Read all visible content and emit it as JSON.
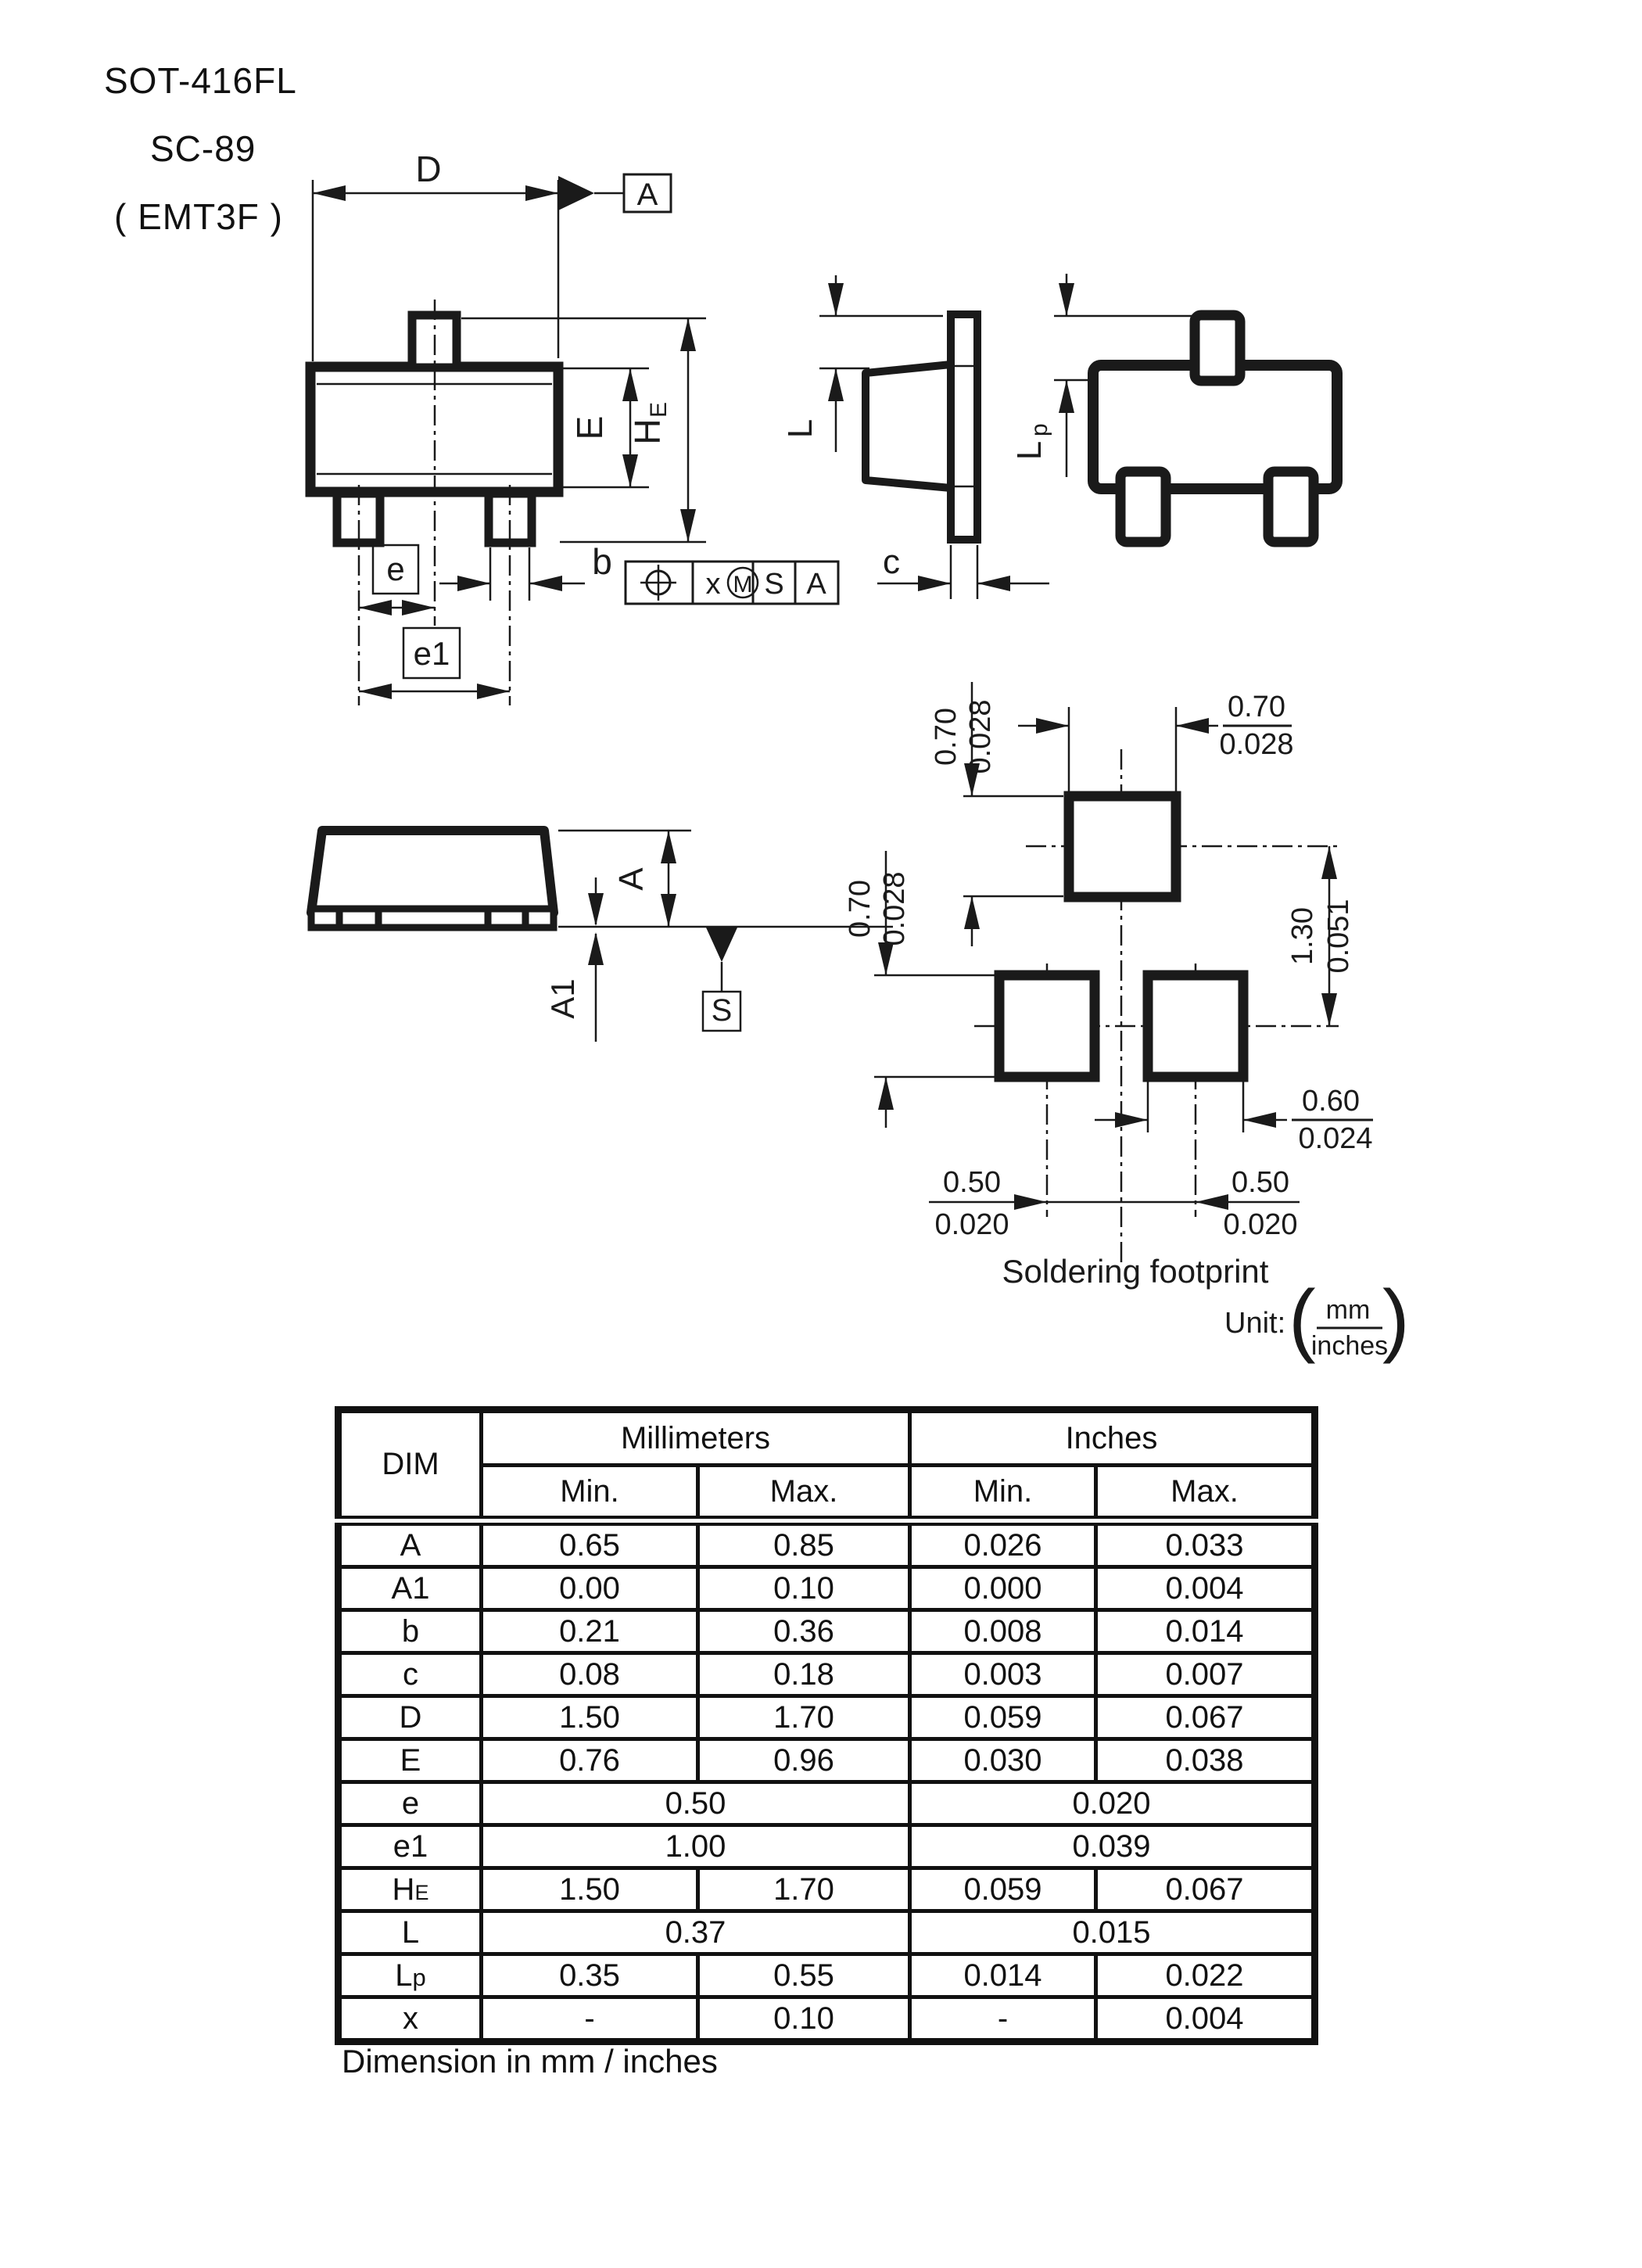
{
  "header": {
    "line1": "SOT-416FL",
    "line2": "SC-89",
    "line3": "( EMT3F )"
  },
  "views": {
    "front": {
      "dim_d": "D",
      "datum_a": "A",
      "dim_e": "E",
      "dim_he_main": "H",
      "dim_he_sub": "E",
      "dim_b": "b",
      "dim_pitch": "e",
      "dim_pitch1": "e1",
      "fcf": {
        "x_label": "x",
        "m_label": "M",
        "s_label": "S",
        "a_label": "A"
      }
    },
    "side": {
      "dim_l": "L",
      "dim_c": "c"
    },
    "top": {
      "dim_lp_main": "L",
      "dim_lp_sub": "p"
    },
    "bottom": {
      "dim_a": "A",
      "dim_a1": "A1",
      "datum_s": "S"
    }
  },
  "footprint": {
    "title": "Soldering footprint",
    "unit_prefix": "Unit:",
    "unit_mm": "mm",
    "unit_inches": "inches",
    "dims": {
      "top_width_mm": "0.70",
      "top_width_in": "0.028",
      "upper_height_mm": "0.70",
      "upper_height_in": "0.028",
      "lower_height_mm": "0.70",
      "lower_height_in": "0.028",
      "vertical_pitch_mm": "1.30",
      "vertical_pitch_in": "0.051",
      "pad_width_mm": "0.60",
      "pad_width_in": "0.024",
      "pitch_left_mm": "0.50",
      "pitch_left_in": "0.020",
      "pitch_right_mm": "0.50",
      "pitch_right_in": "0.020"
    }
  },
  "table": {
    "col_dim": "DIM",
    "col_mm": "Millimeters",
    "col_in": "Inches",
    "mm_min": "Min.",
    "mm_max": "Max.",
    "in_min": "Min.",
    "in_max": "Max.",
    "rows": [
      {
        "dim": "A",
        "mm_min": "0.65",
        "mm_max": "0.85",
        "in_min": "0.026",
        "in_max": "0.033"
      },
      {
        "dim": "A1",
        "mm_min": "0.00",
        "mm_max": "0.10",
        "in_min": "0.000",
        "in_max": "0.004"
      },
      {
        "dim": "b",
        "mm_min": "0.21",
        "mm_max": "0.36",
        "in_min": "0.008",
        "in_max": "0.014"
      },
      {
        "dim": "c",
        "mm_min": "0.08",
        "mm_max": "0.18",
        "in_min": "0.003",
        "in_max": "0.007"
      },
      {
        "dim": "D",
        "mm_min": "1.50",
        "mm_max": "1.70",
        "in_min": "0.059",
        "in_max": "0.067"
      },
      {
        "dim": "E",
        "mm_min": "0.76",
        "mm_max": "0.96",
        "in_min": "0.030",
        "in_max": "0.038"
      },
      {
        "dim": "e",
        "mm": "0.50",
        "in": "0.020"
      },
      {
        "dim": "e1",
        "mm": "1.00",
        "in": "0.039"
      },
      {
        "dim": "H",
        "dim_sub": "E",
        "mm_min": "1.50",
        "mm_max": "1.70",
        "in_min": "0.059",
        "in_max": "0.067"
      },
      {
        "dim": "L",
        "mm": "0.37",
        "in": "0.015"
      },
      {
        "dim": "L",
        "dim_sub": "p",
        "mm_min": "0.35",
        "mm_max": "0.55",
        "in_min": "0.014",
        "in_max": "0.022"
      },
      {
        "dim": "x",
        "mm_min": "-",
        "mm_max": "0.10",
        "in_min": "-",
        "in_max": "0.004"
      }
    ],
    "caption": "Dimension in mm / inches"
  }
}
